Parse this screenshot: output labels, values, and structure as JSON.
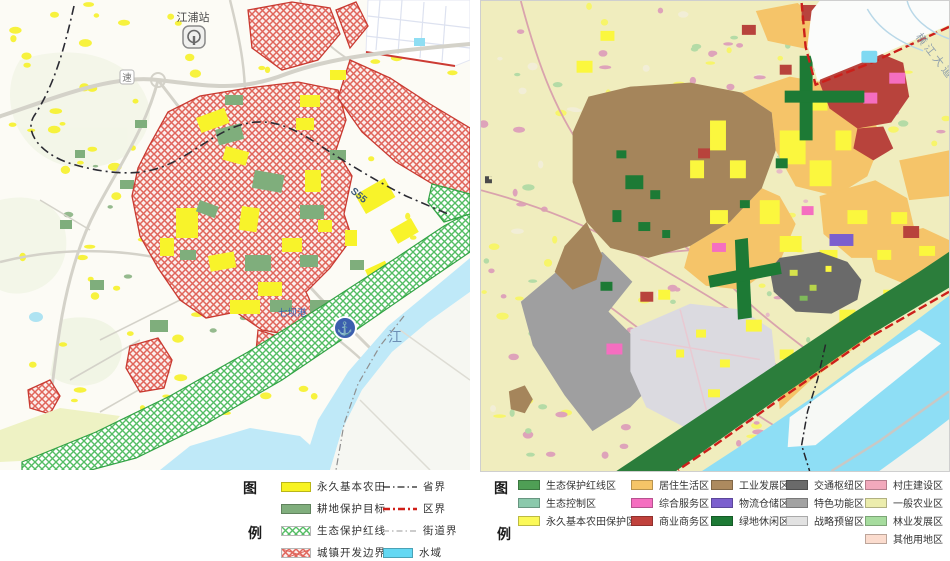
{
  "left_panel": {
    "legend_title_top": "图",
    "legend_title_bottom": "例",
    "map_labels": {
      "station": "江浦站",
      "expressway_shield": "速",
      "road_code": "S55",
      "port": "七坝港",
      "river": "江"
    },
    "legend_fills": [
      {
        "label": "永久基本农田",
        "color": "#f8f321",
        "type": "solid"
      },
      {
        "label": "耕地保护目标",
        "color": "#80ae7d",
        "type": "solid"
      },
      {
        "label": "生态保护红线",
        "color": "#54bd64",
        "type": "hatch-green"
      },
      {
        "label": "城镇开发边界",
        "color": "#df5a50",
        "type": "hatch-red"
      }
    ],
    "legend_lines": [
      {
        "label": "省界",
        "color": "#222222",
        "style": "dash-dot"
      },
      {
        "label": "区界",
        "color": "#d01f18",
        "style": "dash-dot-bold"
      },
      {
        "label": "街道界",
        "color": "#999999",
        "style": "dash-dot-thin"
      },
      {
        "label": "水域",
        "color": "#63d8f3",
        "style": "solid-fill"
      }
    ]
  },
  "right_panel": {
    "legend_title_top": "图",
    "legend_title_bottom": "例",
    "map_labels": {
      "avenue": "横江大道"
    },
    "legend_columns": [
      [
        {
          "label": "生态保护红线区",
          "color": "#4f9f55"
        },
        {
          "label": "生态控制区",
          "color": "#8bc9ac"
        },
        {
          "label": "永久基本农田保护区",
          "color": "#fbf958"
        }
      ],
      [
        {
          "label": "居住生活区",
          "color": "#f6c568"
        },
        {
          "label": "综合服务区",
          "color": "#f56ec0"
        },
        {
          "label": "商业商务区",
          "color": "#c0413c"
        }
      ],
      [
        {
          "label": "工业发展区",
          "color": "#ad8a5f"
        },
        {
          "label": "物流仓储区",
          "color": "#7b5fce"
        },
        {
          "label": "绿地休闲区",
          "color": "#1d7a35"
        }
      ],
      [
        {
          "label": "交通枢纽区",
          "color": "#6a6a6a"
        },
        {
          "label": "特色功能区",
          "color": "#a2a2a2"
        },
        {
          "label": "战略预留区",
          "color": "#e2e2e2"
        }
      ],
      [
        {
          "label": "村庄建设区",
          "color": "#f2a9bc"
        },
        {
          "label": "一般农业区",
          "color": "#ecedad"
        },
        {
          "label": "林业发展区",
          "color": "#a6dc9e"
        },
        {
          "label": "其他用地区",
          "color": "#fbdcce"
        }
      ]
    ]
  }
}
